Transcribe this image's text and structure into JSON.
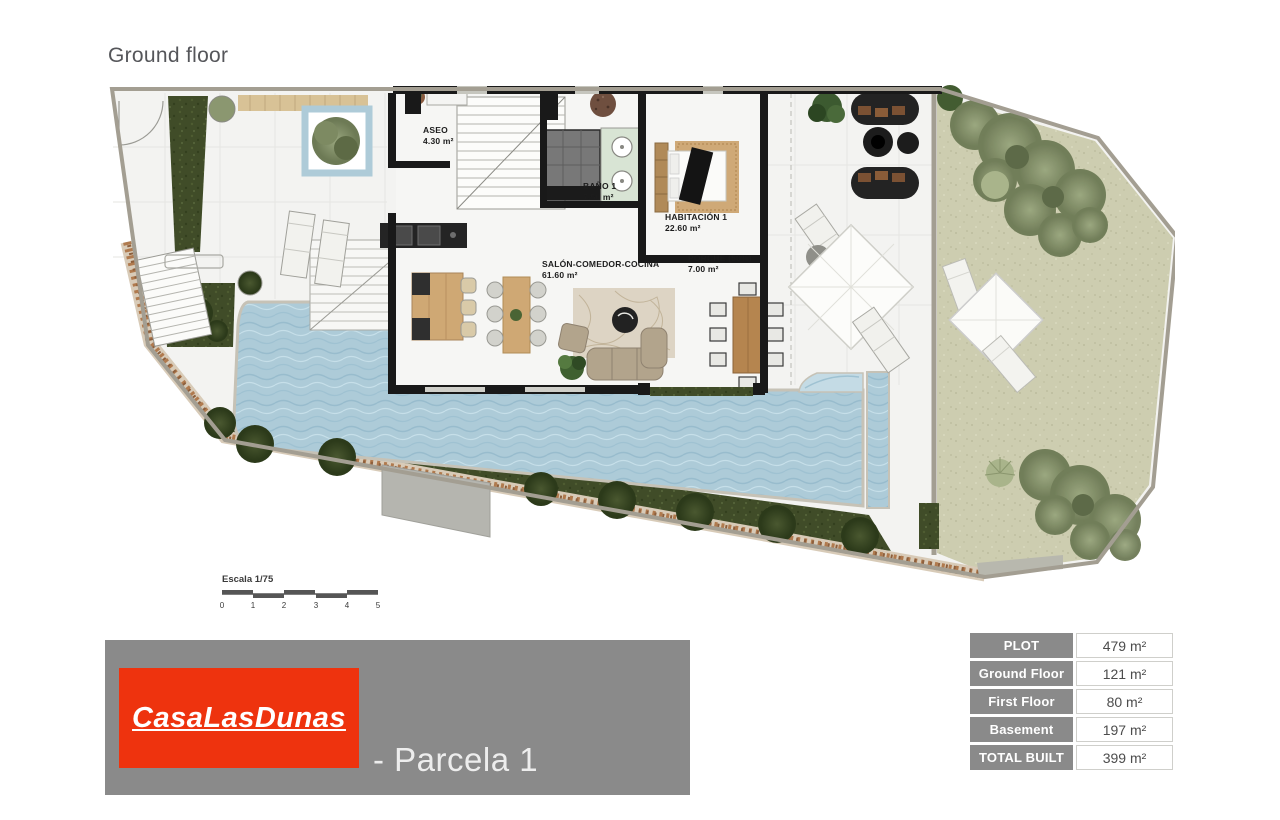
{
  "page": {
    "title": "Ground floor"
  },
  "plan": {
    "rooms": [
      {
        "name": "ASEO",
        "area": "4.30 m²"
      },
      {
        "name": "BAÑO 1",
        "area": "7.50 m²"
      },
      {
        "name": "HABITACIÓN 1",
        "area": "22.60 m²"
      },
      {
        "name": "SALÓN-COMEDOR-COCINA",
        "area": "61.60 m²"
      },
      {
        "name": "PORCHE (50%)",
        "area": "7.00 m²"
      }
    ],
    "scale": {
      "label": "Escala 1/75",
      "ticks": [
        "0",
        "1",
        "2",
        "3",
        "4",
        "5"
      ]
    },
    "colors": {
      "pool_water": "#adcbd8",
      "sand_garden": "#cdcdb0",
      "hedge_green": "#404c28",
      "wall_black": "#191919",
      "floor": "#f3f3f1",
      "wood": "#cfa874",
      "stone_path": "#b07a4e",
      "plot_boundary": "#a39e92"
    }
  },
  "footer": {
    "logo_text": "CasaLasDunas",
    "plot_label": "- Parcela 1",
    "logo_bg": "#ee330e",
    "bar_bg": "#8a8a8a"
  },
  "areas_table": {
    "rows": [
      {
        "label": "PLOT",
        "value": "479 m²"
      },
      {
        "label": "Ground Floor",
        "value": "121 m²"
      },
      {
        "label": "First Floor",
        "value": "80 m²"
      },
      {
        "label": "Basement",
        "value": "197 m²"
      },
      {
        "label": "TOTAL BUILT",
        "value": "399 m²"
      }
    ]
  }
}
